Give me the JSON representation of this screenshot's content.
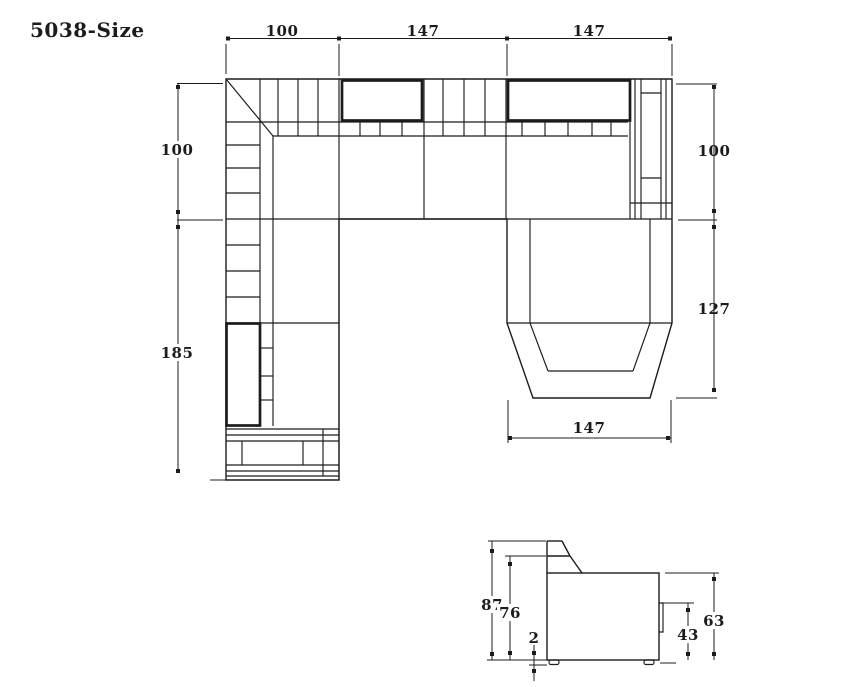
{
  "title": "5038-Size",
  "colors": {
    "line": "#1c1c1c",
    "background": "#ffffff"
  },
  "plan_view": {
    "description": "sectional-sofa-top-view",
    "dims": {
      "top_left_width": "100",
      "top_mid_width": "147",
      "top_right_width": "147",
      "left_upper_depth": "100",
      "left_lower_depth": "185",
      "right_upper_depth": "100",
      "right_chaise_depth": "127",
      "chaise_width": "147"
    }
  },
  "side_view": {
    "description": "sofa-side-elevation",
    "dims": {
      "total_height": "87",
      "back_height": "76",
      "leg_height": "2",
      "arm_panel_height": "43",
      "body_height": "63"
    }
  }
}
